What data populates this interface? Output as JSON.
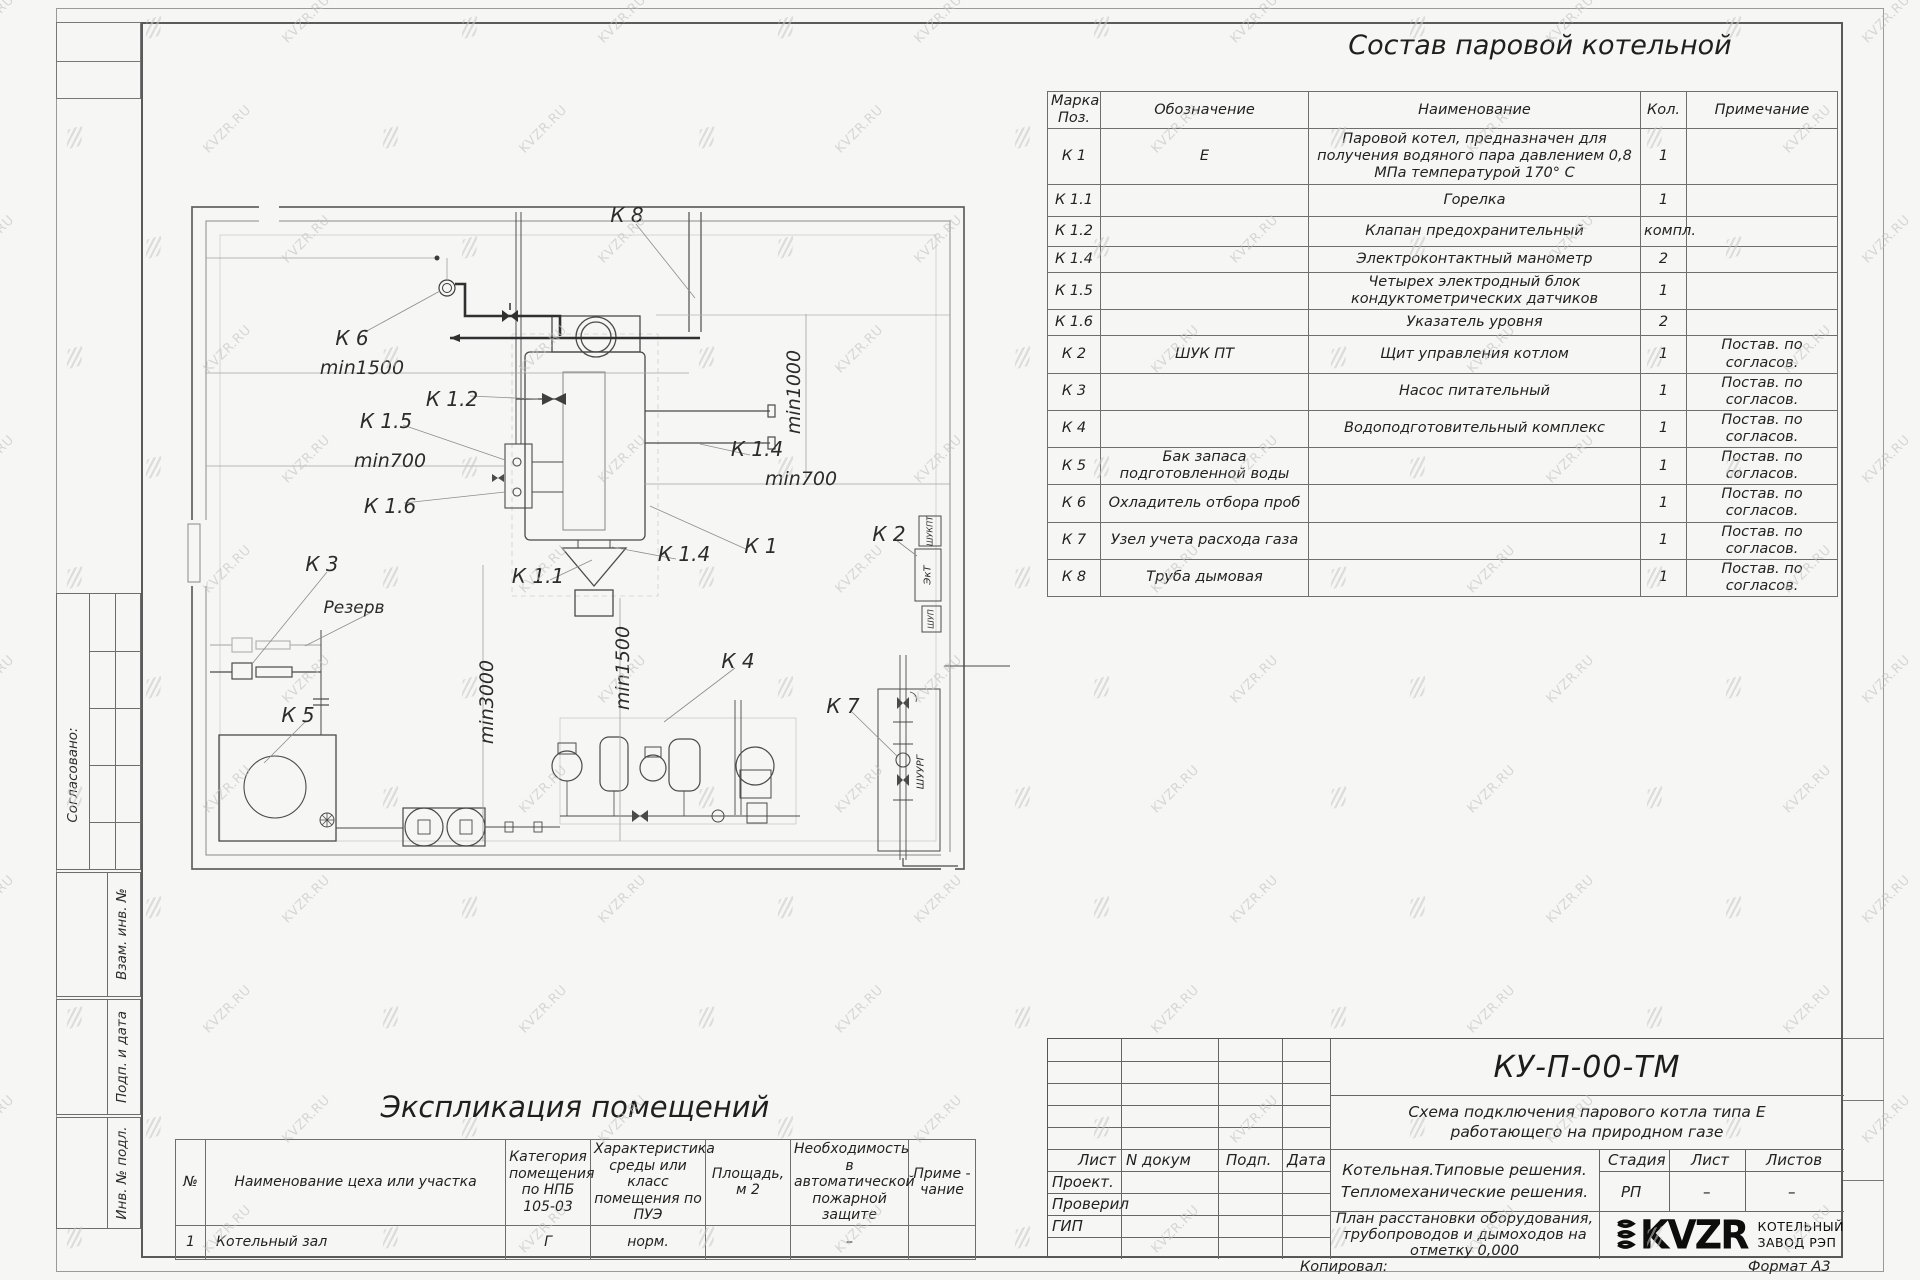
{
  "watermark": {
    "text": "KVZR.RU"
  },
  "composition_table": {
    "title": "Состав паровой котельной",
    "headers": {
      "mark": "Марка Поз.",
      "designation": "Обозначение",
      "name": "Наименование",
      "qty": "Кол.",
      "note": "Примечание"
    },
    "rows": [
      {
        "mark": "К 1",
        "designation": "Е",
        "name": "Паровой котел, предназначен для получения водяного пара давлением  0,8  МПа температурой  170° С",
        "qty": "1",
        "note": ""
      },
      {
        "mark": "К 1.1",
        "designation": "",
        "name": "Горелка",
        "qty": "1",
        "note": ""
      },
      {
        "mark": "К 1.2",
        "designation": "",
        "name": "Клапан предохранительный",
        "qty": "компл.",
        "note": ""
      },
      {
        "mark": "К 1.4",
        "designation": "",
        "name": "Электроконтактный манометр",
        "qty": "2",
        "note": ""
      },
      {
        "mark": "К 1.5",
        "designation": "",
        "name": "Четырех электродный блок кондуктометрических датчиков",
        "qty": "1",
        "note": ""
      },
      {
        "mark": "К 1.6",
        "designation": "",
        "name": "Указатель уровня",
        "qty": "2",
        "note": ""
      },
      {
        "mark": "К 2",
        "designation": "ШУК ПТ",
        "name": "Щит управления котлом",
        "qty": "1",
        "note": "Постав. по согласов."
      },
      {
        "mark": "К 3",
        "designation": "",
        "name": "Насос питательный",
        "qty": "1",
        "note": "Постав. по согласов."
      },
      {
        "mark": "К 4",
        "designation": "",
        "name": "Водоподготовительный комплекс",
        "qty": "1",
        "note": "Постав. по согласов."
      },
      {
        "mark": "К 5",
        "designation": "Бак запаса подготовленной воды",
        "name": "",
        "qty": "1",
        "note": "Постав. по согласов."
      },
      {
        "mark": "К 6",
        "designation": "Охладитель отбора проб",
        "name": "",
        "qty": "1",
        "note": "Постав. по согласов."
      },
      {
        "mark": "К 7",
        "designation": "Узел учета расхода газа",
        "name": "",
        "qty": "1",
        "note": "Постав. по согласов."
      },
      {
        "mark": "К 8",
        "designation": "Труба дымовая",
        "name": "",
        "qty": "1",
        "note": "Постав. по согласов."
      }
    ]
  },
  "plan": {
    "labels": [
      {
        "text": "К 8"
      },
      {
        "text": "К 6"
      },
      {
        "text": "min1500"
      },
      {
        "text": "К 1.2"
      },
      {
        "text": "К 1.5"
      },
      {
        "text": "min700"
      },
      {
        "text": "К 1.6"
      },
      {
        "text": "К 3"
      },
      {
        "text": "Резерв"
      },
      {
        "text": "К 5"
      },
      {
        "text": "min3000"
      },
      {
        "text": "min1500"
      },
      {
        "text": "К 1.1"
      },
      {
        "text": "К 4"
      },
      {
        "text": "К 7"
      },
      {
        "text": "К 1.4"
      },
      {
        "text": "min700"
      },
      {
        "text": "min1000"
      },
      {
        "text": "К 1"
      },
      {
        "text": "К 1.4"
      },
      {
        "text": "К 2"
      },
      {
        "text": "ШУКПТ"
      },
      {
        "text": "ЭкТ"
      },
      {
        "text": "ШУП"
      },
      {
        "text": "ШУУРГ"
      }
    ]
  },
  "explication_table": {
    "title": "Экспликация помещений",
    "headers": {
      "num": "№",
      "name": "Наименование цеха или участка",
      "category": "Категория помещения по НПБ 105-03",
      "env": "Характеристика среды или класс помещения по ПУЭ",
      "area": "Площадь, м 2",
      "fire": "Необходимость в автоматической пожарной защите",
      "note": "Приме - чание"
    },
    "rows": [
      {
        "num": "1",
        "name": "Котельный зал",
        "category": "Г",
        "env": "норм.",
        "area": "",
        "fire": "–",
        "note": ""
      }
    ]
  },
  "title_block": {
    "doc_number": "КУ-П-00-ТМ",
    "subtitle_line1": "Схема подключения парового котла типа Е",
    "subtitle_line2": "работающего на природном газе",
    "rev_headers": {
      "sheet": "Лист",
      "doc": "N докум",
      "sign": "Подп.",
      "date": "Дата"
    },
    "roles": [
      {
        "label": "Проект."
      },
      {
        "label": "Проверил"
      },
      {
        "label": "ГИП"
      }
    ],
    "object_line1": "Котельная.Типовые решения.",
    "object_line2": "Тепломеханические решения.",
    "stage_header": "Стадия",
    "sheet_header": "Лист",
    "sheets_header": "Листов",
    "stage_value": "РП",
    "sheet_value": "–",
    "sheets_value": "–",
    "drawing_name": "План расстановки оборудования, трубопроводов и дымоходов на отметку  0,000",
    "logo_text": "KVZR",
    "logo_caption1": "КОТЕЛЬНЫЙ",
    "logo_caption2": "ЗАВОД РЭП",
    "copied_label": "Копировал:",
    "format_label": "Формат А3"
  },
  "margin_labels": {
    "agreed": "Согласовано:",
    "replace_inv": "Взам. инв. №",
    "sign_date": "Подп. и дата",
    "inv_orig": "Инв. № подл."
  }
}
